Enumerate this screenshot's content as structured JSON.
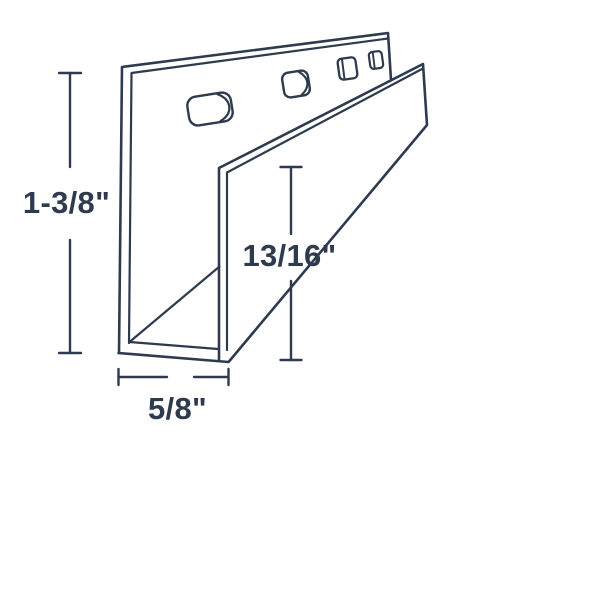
{
  "diagram": {
    "background_color": "#ffffff",
    "line_color": "#2e3a4d",
    "labels": {
      "overall_height": "1-3/8\"",
      "opening_height": "13/16\"",
      "channel_width": "5/8\""
    }
  }
}
